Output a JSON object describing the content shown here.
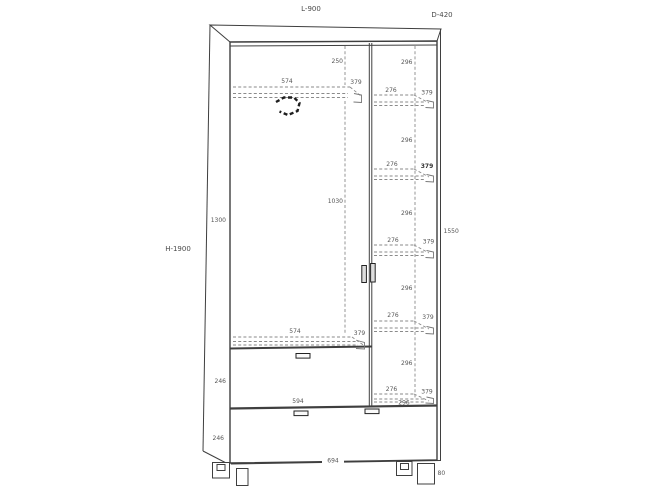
{
  "overall": {
    "width_label": "L-900",
    "depth_label": "D-420",
    "height_label": "H-1900"
  },
  "dims": [
    {
      "name": "left-top-gap",
      "t": "250"
    },
    {
      "name": "right-spacing-1",
      "t": "296"
    },
    {
      "name": "left-compartment-width-top",
      "t": "574"
    },
    {
      "name": "left-compartment-depth-top",
      "t": "379"
    },
    {
      "name": "shelf1-width",
      "t": "276"
    },
    {
      "name": "shelf1-depth",
      "t": "379"
    },
    {
      "name": "right-spacing-2",
      "t": "296"
    },
    {
      "name": "shelf2-width",
      "t": "276"
    },
    {
      "name": "shelf2-depth",
      "t": "379"
    },
    {
      "name": "rod-to-drawer-height",
      "t": "1030"
    },
    {
      "name": "door-height",
      "t": "1300"
    },
    {
      "name": "right-spacing-3",
      "t": "296"
    },
    {
      "name": "right-column-height",
      "t": "1550"
    },
    {
      "name": "shelf3-width",
      "t": "276"
    },
    {
      "name": "shelf3-depth",
      "t": "379"
    },
    {
      "name": "right-spacing-4",
      "t": "296"
    },
    {
      "name": "shelf4-width",
      "t": "276"
    },
    {
      "name": "shelf4-depth",
      "t": "379"
    },
    {
      "name": "left-compartment-width-bottom",
      "t": "574"
    },
    {
      "name": "left-compartment-depth-bottom",
      "t": "379"
    },
    {
      "name": "drawer1-height",
      "t": "246"
    },
    {
      "name": "right-spacing-5",
      "t": "296"
    },
    {
      "name": "shelf5-width",
      "t": "276"
    },
    {
      "name": "shelf5-depth",
      "t": "379"
    },
    {
      "name": "drawer1-width",
      "t": "594"
    },
    {
      "name": "right-spacing-6",
      "t": "296"
    },
    {
      "name": "drawer2-height",
      "t": "246"
    },
    {
      "name": "drawer2-width",
      "t": "694"
    },
    {
      "name": "leg-height",
      "t": "80"
    }
  ],
  "colors": {
    "background": "#ffffff",
    "outline": "#3f3f3f",
    "dimension_lines": "#8a8a8a",
    "text": "#555555"
  }
}
